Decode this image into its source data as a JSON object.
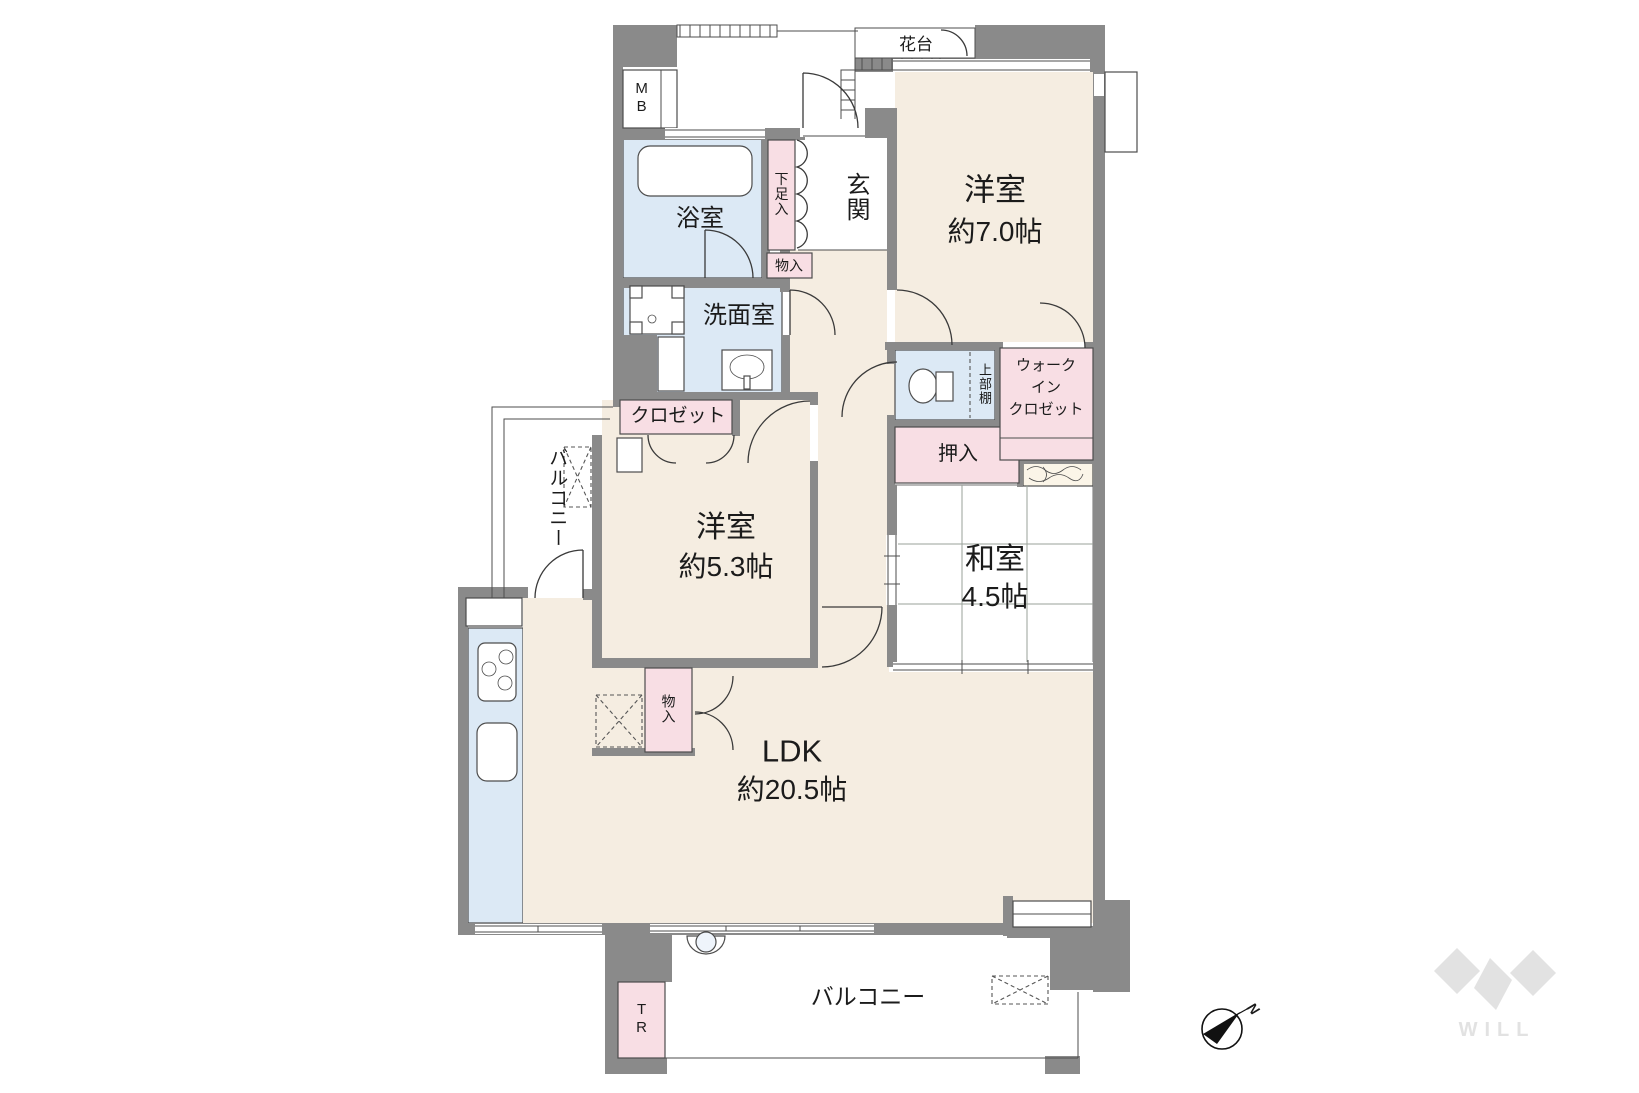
{
  "plan": {
    "rooms": {
      "west7": {
        "name": "洋室",
        "size": "約7.0帖"
      },
      "west5": {
        "name": "洋室",
        "size": "約5.3帖"
      },
      "washitsu": {
        "name": "和室",
        "size": "4.5帖"
      },
      "ldk": {
        "name": "LDK",
        "size": "約20.5帖"
      },
      "genkan": "玄関",
      "bath": "浴室",
      "washroom": "洗面室",
      "balcony_west": "バルコニー",
      "balcony_south": "バルコニー",
      "kadai": "花台"
    },
    "storage": {
      "mb": "MB",
      "tr": "TR",
      "geta": "下足入",
      "monoire_hall": "物入",
      "monoire_ldk": "物入",
      "closet": "クロゼット",
      "oshiire": "押入",
      "upper_shelf": "上部棚",
      "wic": [
        "ウォーク",
        "イン",
        "クロゼット"
      ]
    },
    "compass": {
      "north_label": "N"
    },
    "brand": {
      "name": "WILL"
    },
    "colors": {
      "wall": "#8A8A8A",
      "room": "#F5EDE1",
      "wet": "#DCE9F5",
      "closet": "#F8DEE4",
      "tatami": "#E7EEE5",
      "wood": "#FBF5E8",
      "line": "#4D4D4D",
      "logo": "#E2E2E2",
      "text": "#1B1B1B"
    }
  }
}
